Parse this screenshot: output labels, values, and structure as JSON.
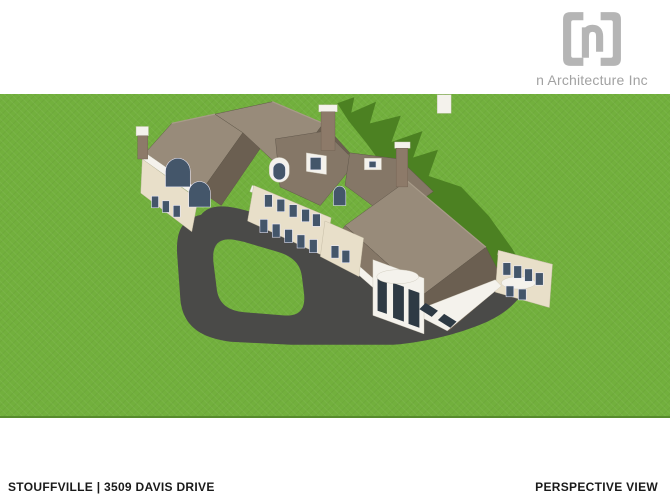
{
  "header": {
    "logo": {
      "company_name": "n Architecture Inc",
      "icon": "n-brackets-logo"
    }
  },
  "footer": {
    "project_location": "STOUFFVILLE | 3509 DAVIS DRIVE",
    "view_label": "PERSPECTIVE VIEW"
  },
  "rendering": {
    "type": "3d-perspective-architectural-rendering",
    "subject": "Aerial perspective of a two-storey hip-roof residence with circular driveway, lawn and cast shadow",
    "colors": {
      "lawn": "#72b03d",
      "lawn_edge": "#578c2c",
      "shadow": "#4c8122",
      "driveway": "#4a4a48",
      "roof_light": "#988b7a",
      "roof_mid": "#857767",
      "roof_dark": "#6b5f51",
      "roof_deep": "#5e5448",
      "wall": "#e8dfc9",
      "trim": "#f4f2ec",
      "window": "#44566a",
      "window_dark": "#2e3a44",
      "brick": "#8d7a69",
      "logo_gray": "#b5b5b5",
      "logo_text": "#a2a2a2",
      "footer_text": "#1a1a1a"
    }
  }
}
